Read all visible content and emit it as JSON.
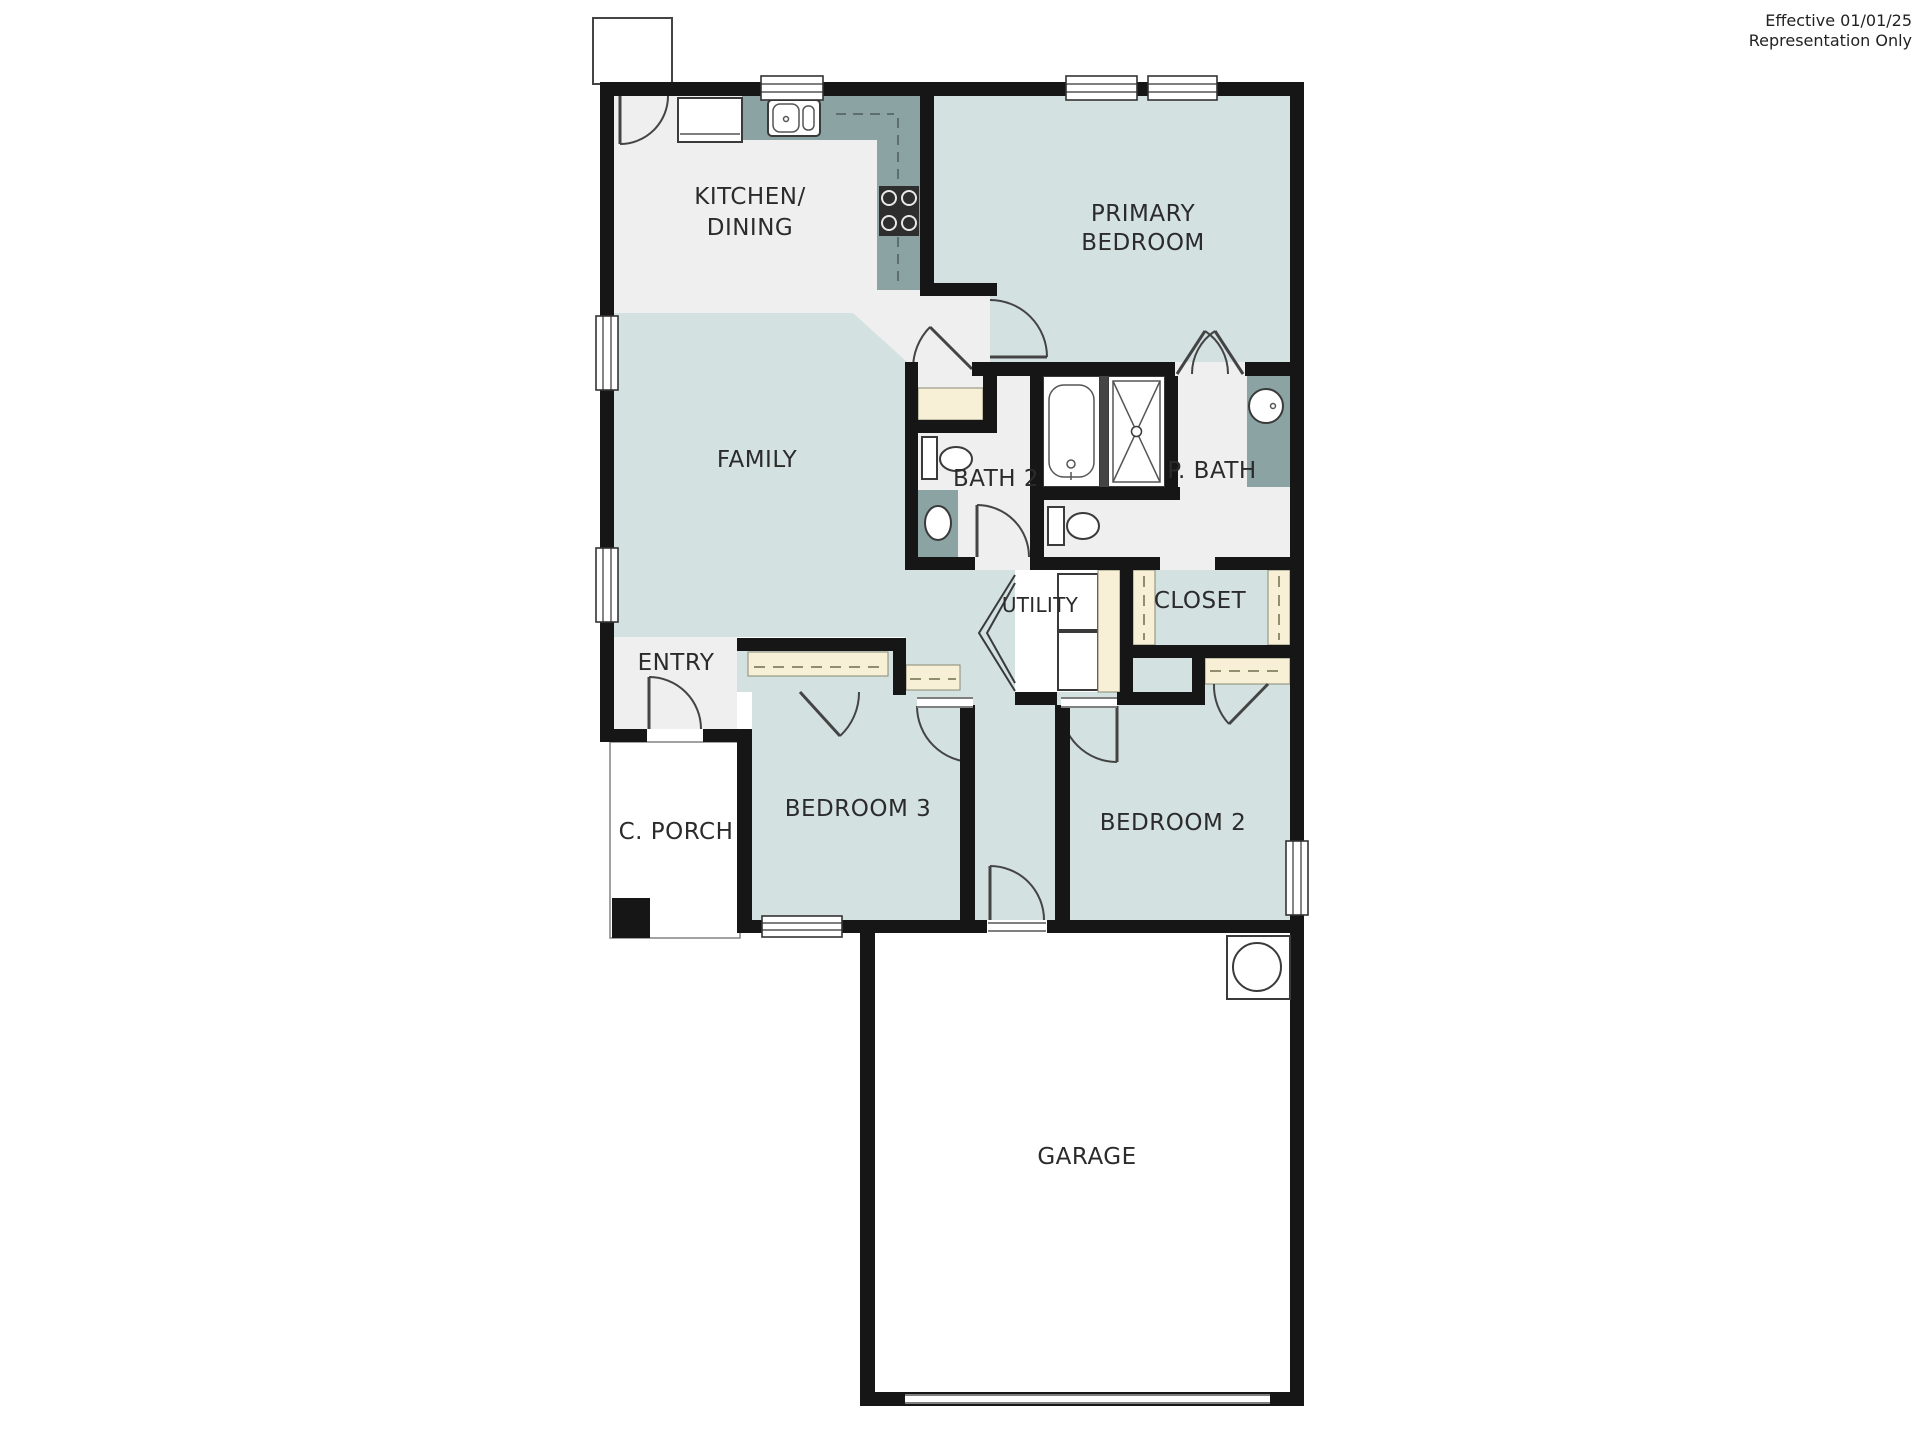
{
  "annotation": {
    "line1": "Effective 01/01/25",
    "line2": "Representation Only"
  },
  "colors": {
    "room_fill": "#d3e1e0",
    "floor_light": "#eeefee",
    "counter": "#8ca3a3",
    "millwork_cream": "#f7f0d7",
    "wall": "#161616"
  },
  "rooms": {
    "kitchen_line1": "KITCHEN/",
    "kitchen_line2": "DINING",
    "primary_line1": "PRIMARY",
    "primary_line2": "BEDROOM",
    "family": "FAMILY",
    "bath2": "BATH 2",
    "primary_bath": "P. BATH",
    "utility": "UTILITY",
    "closet": "CLOSET",
    "entry": "ENTRY",
    "covered_porch": "C. PORCH",
    "bedroom3": "BEDROOM 3",
    "bedroom2": "BEDROOM 2",
    "garage": "GARAGE"
  }
}
